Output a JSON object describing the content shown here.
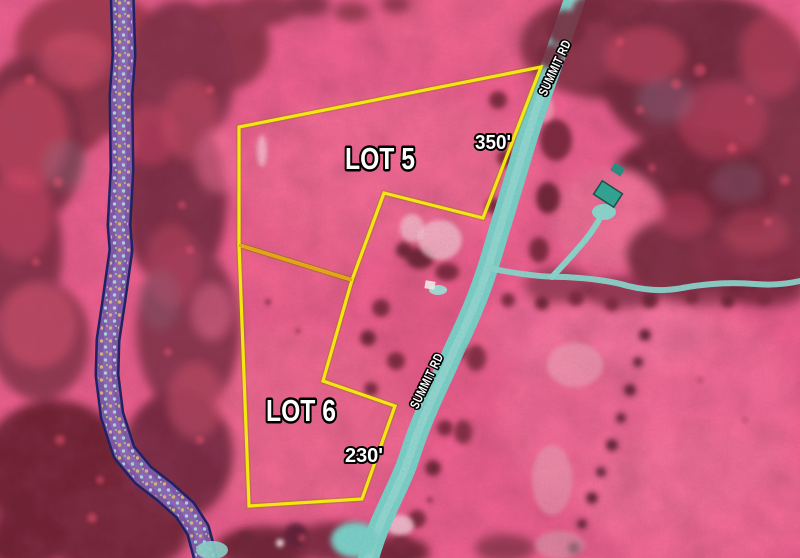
{
  "map": {
    "road": {
      "name": "SUMMIT RD",
      "labels": [
        "SUMMIT RD",
        "SUMMIT RD"
      ]
    },
    "lots": [
      {
        "id": "lot5",
        "label": "LOT 5",
        "frontage": "350'",
        "boundary_points": "239,127 541,67 483,218 384,193 352,280 239,245"
      },
      {
        "id": "lot6",
        "label": "LOT 6",
        "frontage": "230'",
        "boundary_points": "239,245 352,280 323,381 395,406 362,499 249,506"
      }
    ],
    "divider_points": "239,245 352,280",
    "colors": {
      "lot_boundary": "#f2e712",
      "lot_divider": "#e6a117",
      "road": "#78d1c8",
      "road_highlight": "#a3e0d7",
      "driveway": "#8ad6cc",
      "stream_fill": "#7e58a8",
      "stream_border": "#1c2264",
      "field_pink": "#ee6190",
      "forest_maroon": "#7c2d40",
      "label_fill": "#ffffff",
      "label_outline": "#000000"
    }
  }
}
